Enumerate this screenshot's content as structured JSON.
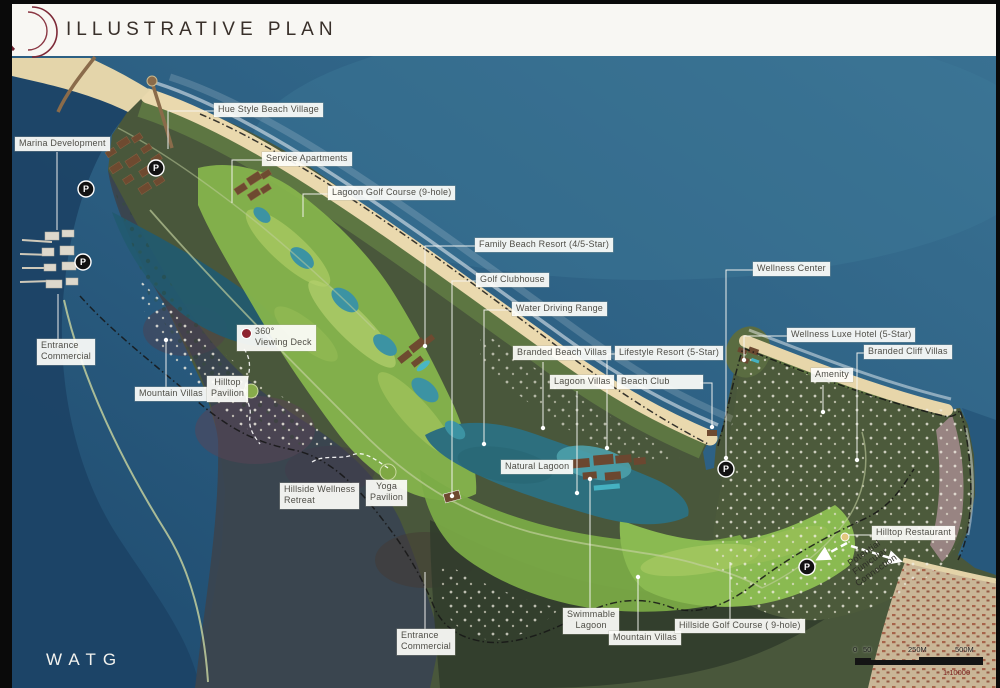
{
  "header": {
    "title": "ILLUSTRATIVE PLAN"
  },
  "branding": {
    "logo_text": "WATG",
    "logo_accent_color": "#7d2937"
  },
  "map": {
    "parking_label": "P",
    "parking_markers": [
      {
        "x": 156,
        "y": 168
      },
      {
        "x": 86,
        "y": 189
      },
      {
        "x": 83,
        "y": 262
      },
      {
        "x": 726,
        "y": 469
      },
      {
        "x": 807,
        "y": 567
      }
    ],
    "labels": [
      {
        "id": "hue-style-beach-village",
        "text": "Hue Style Beach Village",
        "x": 214,
        "y": 103
      },
      {
        "id": "marina-development",
        "text": "Marina Development",
        "x": 15,
        "y": 137
      },
      {
        "id": "service-apartments",
        "text": "Service Apartments",
        "x": 262,
        "y": 152
      },
      {
        "id": "lagoon-golf-course",
        "text": "Lagoon Golf Course (9-hole)",
        "x": 328,
        "y": 186
      },
      {
        "id": "family-beach-resort",
        "text": "Family Beach Resort (4/5-Star)",
        "x": 475,
        "y": 238
      },
      {
        "id": "golf-clubhouse",
        "text": "Golf Clubhouse",
        "x": 476,
        "y": 273
      },
      {
        "id": "water-driving-range",
        "text": "Water Driving Range",
        "x": 512,
        "y": 302
      },
      {
        "id": "branded-beach-villas",
        "text": "Branded Beach Villas",
        "x": 513,
        "y": 346
      },
      {
        "id": "lifestyle-resort",
        "text": "Lifestyle Resort (5-Star)",
        "x": 615,
        "y": 346
      },
      {
        "id": "lagoon-villas",
        "text": "Lagoon Villas",
        "x": 550,
        "y": 375
      },
      {
        "id": "beach-club",
        "text": "Beach Club",
        "x": 617,
        "y": 375,
        "w": 78
      },
      {
        "id": "wellness-center",
        "text": "Wellness Center",
        "x": 753,
        "y": 262
      },
      {
        "id": "wellness-luxe-hotel",
        "text": "Wellness Luxe Hotel (5-Star)",
        "x": 787,
        "y": 328
      },
      {
        "id": "branded-cliff-villas",
        "text": "Branded Cliff Villas",
        "x": 864,
        "y": 345
      },
      {
        "id": "amenity",
        "text": "Amenity",
        "x": 811,
        "y": 368
      },
      {
        "id": "entrance-commercial-west",
        "text": "Entrance\nCommercial",
        "x": 37,
        "y": 339,
        "align": "left"
      },
      {
        "id": "mountain-villas-west",
        "text": "Mountain Villas",
        "x": 135,
        "y": 387
      },
      {
        "id": "hilltop-pavilion",
        "text": "Hilltop\nPavilion",
        "x": 207,
        "y": 376,
        "align": "center"
      },
      {
        "id": "viewing-deck",
        "text": "360°\nViewing Deck",
        "x": 237,
        "y": 325,
        "align": "left",
        "marker": "red-dot"
      },
      {
        "id": "natural-lagoon",
        "text": "Natural Lagoon",
        "x": 501,
        "y": 460
      },
      {
        "id": "hillside-wellness-retreat",
        "text": "Hillside Wellness\nRetreat",
        "x": 280,
        "y": 483,
        "align": "left"
      },
      {
        "id": "yoga-pavilion",
        "text": "Yoga\nPavilion",
        "x": 366,
        "y": 480,
        "align": "center"
      },
      {
        "id": "entrance-commercial-south",
        "text": "Entrance\nCommercial",
        "x": 397,
        "y": 629,
        "align": "left"
      },
      {
        "id": "swimmable-lagoon",
        "text": "Swimmable\nLagoon",
        "x": 563,
        "y": 608,
        "align": "center"
      },
      {
        "id": "mountain-villas-south",
        "text": "Mountain Villas",
        "x": 609,
        "y": 631
      },
      {
        "id": "hillside-golf-course",
        "text": "Hillside Golf Course ( 9-hole)",
        "x": 675,
        "y": 619
      },
      {
        "id": "hilltop-restaurant",
        "text": "Hilltop Restaurant",
        "x": 872,
        "y": 526
      }
    ],
    "annotations": {
      "funicular": "Potential\nFunicular\nConnection"
    },
    "scale_bar": {
      "zero": "0",
      "fifty": "50",
      "mid": "250M",
      "end": "500M",
      "ratio": "1:10000"
    },
    "colors": {
      "ocean": "#34678a",
      "deep_water": "#1c4366",
      "sand": "#ead9ae",
      "golf_green": "#86b44c",
      "lagoon": "#2d6f7e",
      "label_text": "#4f4e47",
      "viewing_deck_dot": "#8e2430",
      "boundary": "#161616"
    }
  }
}
